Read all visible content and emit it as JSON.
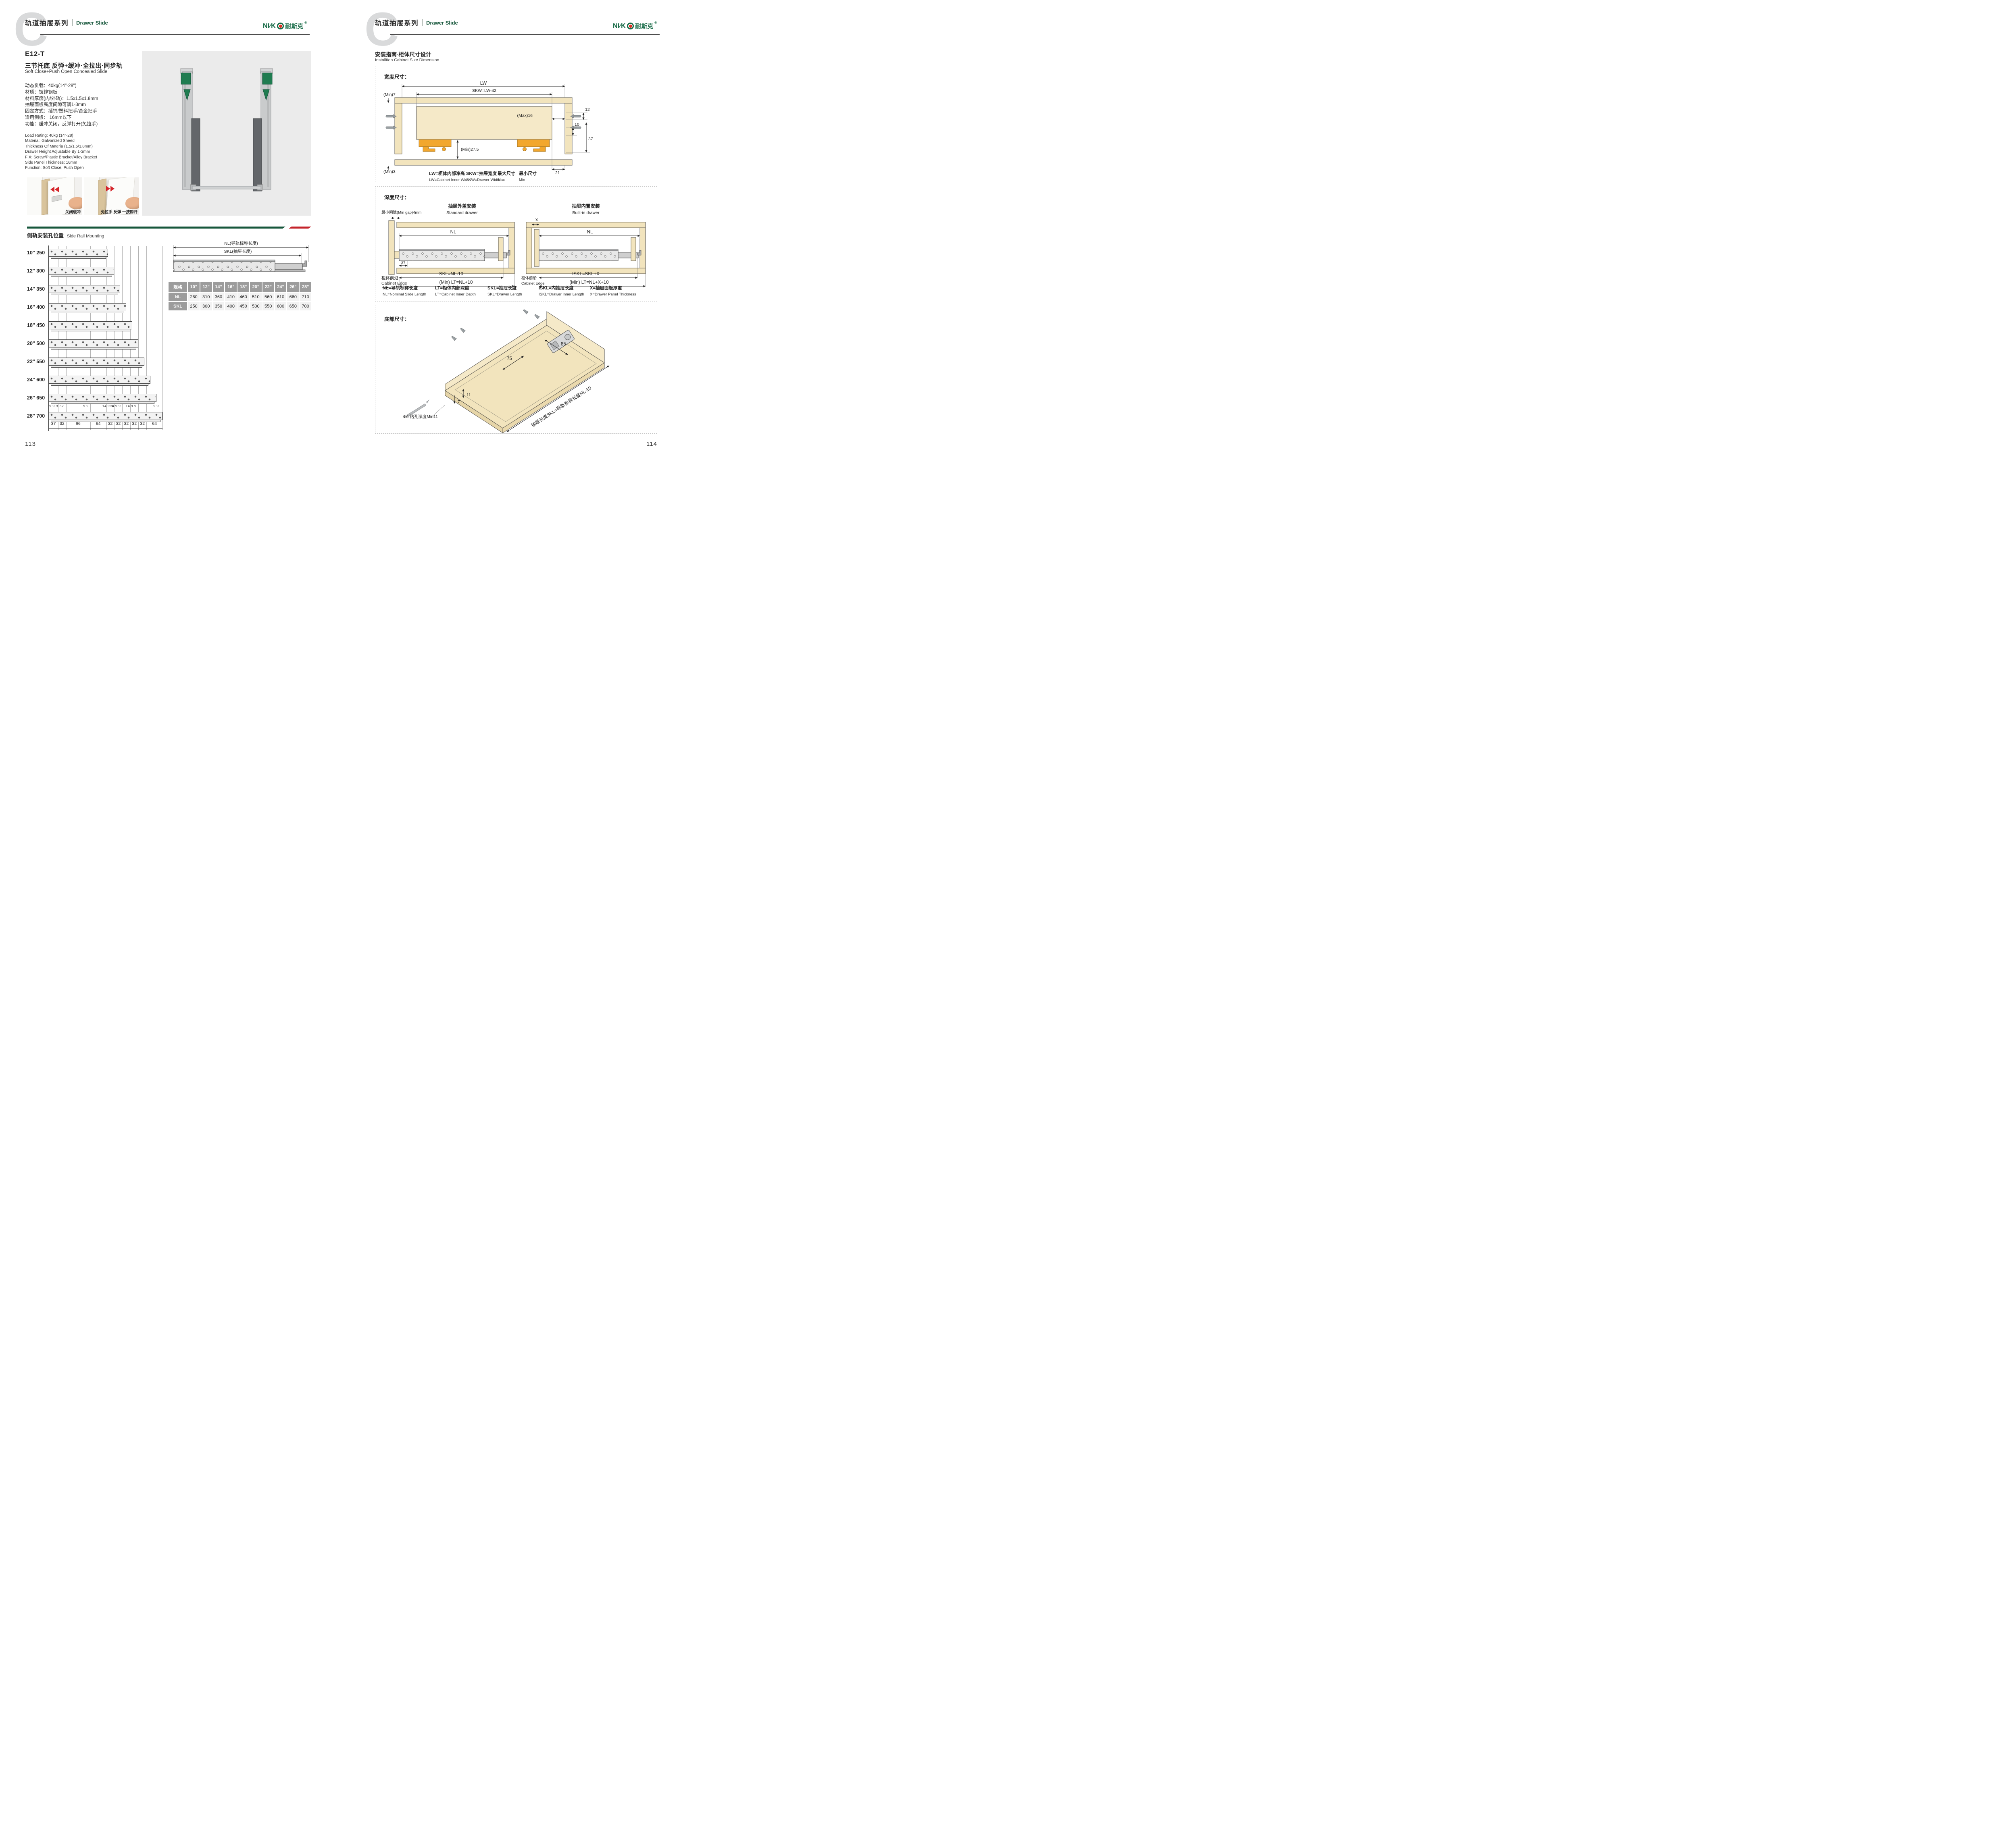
{
  "colors": {
    "green": "#17573c",
    "red": "#c4242b",
    "logo_green": "#156945",
    "logo_dot": "#e02b20",
    "wood": "#f2e4bd",
    "orange": "#f2a72e",
    "photo_bg": "#ebebeb",
    "table_header_gray": "#9c9c9c",
    "watermark_gray": "#d9dadb"
  },
  "header": {
    "watermark": "C",
    "series_cn": "轨道抽屉系列",
    "series_en": "Drawer Slide"
  },
  "brand": {
    "prefix": "NI∕K",
    "cn": "耐斯克",
    "reg": "®"
  },
  "page_left": {
    "product": {
      "model": "E12-T",
      "title_cn": "三节托底 反弹+缓冲·全拉出·同步轨",
      "title_en": "Soft Close+Push Open Concealed Slide",
      "specs_cn": [
        "动态负载：40kg(14\"-28\")",
        "材质：镀锌钢板",
        "材料厚度(内/外轨)：1.5x1.5x1.8mm",
        "抽屉面板高度间隙可调1-3mm",
        "固定方式：插销/塑料把手/合金把手",
        "适用侧板： 16mm以下",
        "功能：缓冲关闭，反弹打开(免拉手)"
      ],
      "specs_en": [
        "Load Rating: 40kg (14\"-28)",
        "Material: Galvanized Sheed",
        "Thickness Of Materia (1.5/1.5/1.8mm)",
        "Drawer Height Adjustable By 1-3mm",
        "FIX: Screw/Plastic Bracket/Alloy Bracket",
        "Side Panel Thickness: 16mm",
        "Function: Soft Close, Push Open"
      ]
    },
    "photos": [
      {
        "caption": "关闭缓冲"
      },
      {
        "caption": "免拉手 反弹 一按即开"
      }
    ],
    "mounting": {
      "title_cn": "侧轨安装孔位置",
      "title_en": "Side Rail Mounting",
      "rows": [
        {
          "inch": "10\"",
          "mm": 250
        },
        {
          "inch": "12\"",
          "mm": 300
        },
        {
          "inch": "14\"",
          "mm": 350
        },
        {
          "inch": "16\"",
          "mm": 400
        },
        {
          "inch": "18\"",
          "mm": 450
        },
        {
          "inch": "20\"",
          "mm": 500
        },
        {
          "inch": "22\"",
          "mm": 550
        },
        {
          "inch": "24\"",
          "mm": 600
        },
        {
          "inch": "26\"",
          "mm": 650
        },
        {
          "inch": "28\"",
          "mm": 700
        }
      ],
      "top_dims": [
        "9 9 9",
        "32",
        "9 9",
        "14 9 9",
        "14 9 9",
        "14 9 9",
        "9 9"
      ],
      "bottom_dims": [
        "37",
        "32",
        "96",
        "64",
        "32",
        "32",
        "32",
        "32",
        "32",
        "64"
      ]
    },
    "slide_diagram": {
      "nl": "NL(导轨标称长度)",
      "skl": "SKL(抽屉长度)"
    },
    "table": {
      "corner": "规格",
      "sizes": [
        "10\"",
        "12\"",
        "14\"",
        "16\"",
        "18\"",
        "20\"",
        "22\"",
        "24\"",
        "26\"",
        "28\""
      ],
      "rows": [
        {
          "label": "NL",
          "values": [
            "260",
            "310",
            "360",
            "410",
            "460",
            "510",
            "560",
            "610",
            "660",
            "710"
          ]
        },
        {
          "label": "SKL",
          "values": [
            "250",
            "300",
            "350",
            "400",
            "450",
            "500",
            "550",
            "600",
            "650",
            "700"
          ]
        }
      ]
    },
    "page_number": "113"
  },
  "page_right": {
    "section": {
      "title_cn": "安装指南-柜体尺寸设计",
      "title_en": "Installtion Cabinet Size Dimension"
    },
    "width_box": {
      "title": "宽度尺寸：",
      "dims": {
        "lw": "LW",
        "skw": "SKW=LW-42",
        "min7": "(Min)7",
        "max16": "(Max)16",
        "d12": "12",
        "d10": "10",
        "d37": "37",
        "min275": "(Min)27.5",
        "min3": "(Min)3",
        "d21": "21"
      },
      "legend": [
        {
          "cn": "LW=柜体内部净高",
          "en": "LW=Cabinet Inner Width"
        },
        {
          "cn": "SKW=抽屉宽度",
          "en": "SKW=Drawer Width"
        },
        {
          "cn": "最大尺寸",
          "en": "Max"
        },
        {
          "cn": "最小尺寸",
          "en": "Min"
        }
      ]
    },
    "depth_box": {
      "title": "深度尺寸：",
      "standard": {
        "title_cn": "抽屉外盖安装",
        "title_en": "Standard drawer",
        "min_gap": "最小间隙(Min gap)4mm",
        "nl": "NL",
        "d37": "37",
        "skl": "SKL=NL-10",
        "lt": "(Min) LT=NL+10",
        "edge_cn": "柜体前沿",
        "edge_en": "Cabinet Edge"
      },
      "builtin": {
        "title_cn": "抽屉内置安装",
        "title_en": "Built-in drawer",
        "x": "X",
        "nl": "NL",
        "iskl": "ISKL=SKL+X",
        "lt": "(Min) LT=NL+X+10",
        "edge_cn": "柜体前沿",
        "edge_en": "Cabinet Edge"
      },
      "legend": [
        {
          "cn": "NL=导轨标称长度",
          "en": "NL=Nominal Slide Length"
        },
        {
          "cn": "LT=柜体内部深度",
          "en": "LT=Cabinet Inner Depth"
        },
        {
          "cn": "SKL=抽屉长度",
          "en": "SKL=Drawer Length"
        },
        {
          "cn": "ISKL=内抽屉长度",
          "en": "ISKL=Drawer Inner Length"
        },
        {
          "cn": "X=抽屉面板厚度",
          "en": "X=Drawer Panel Thickness"
        }
      ]
    },
    "bottom_box": {
      "title": "底部尺寸：",
      "dims": {
        "d75": "75",
        "d85": "85",
        "d11": "11",
        "d7": "7",
        "drill": "Φ6 钻孔深度Min11",
        "skl": "抽屉长度SKL=导轨标称长度NL-10"
      }
    },
    "page_number": "114"
  }
}
